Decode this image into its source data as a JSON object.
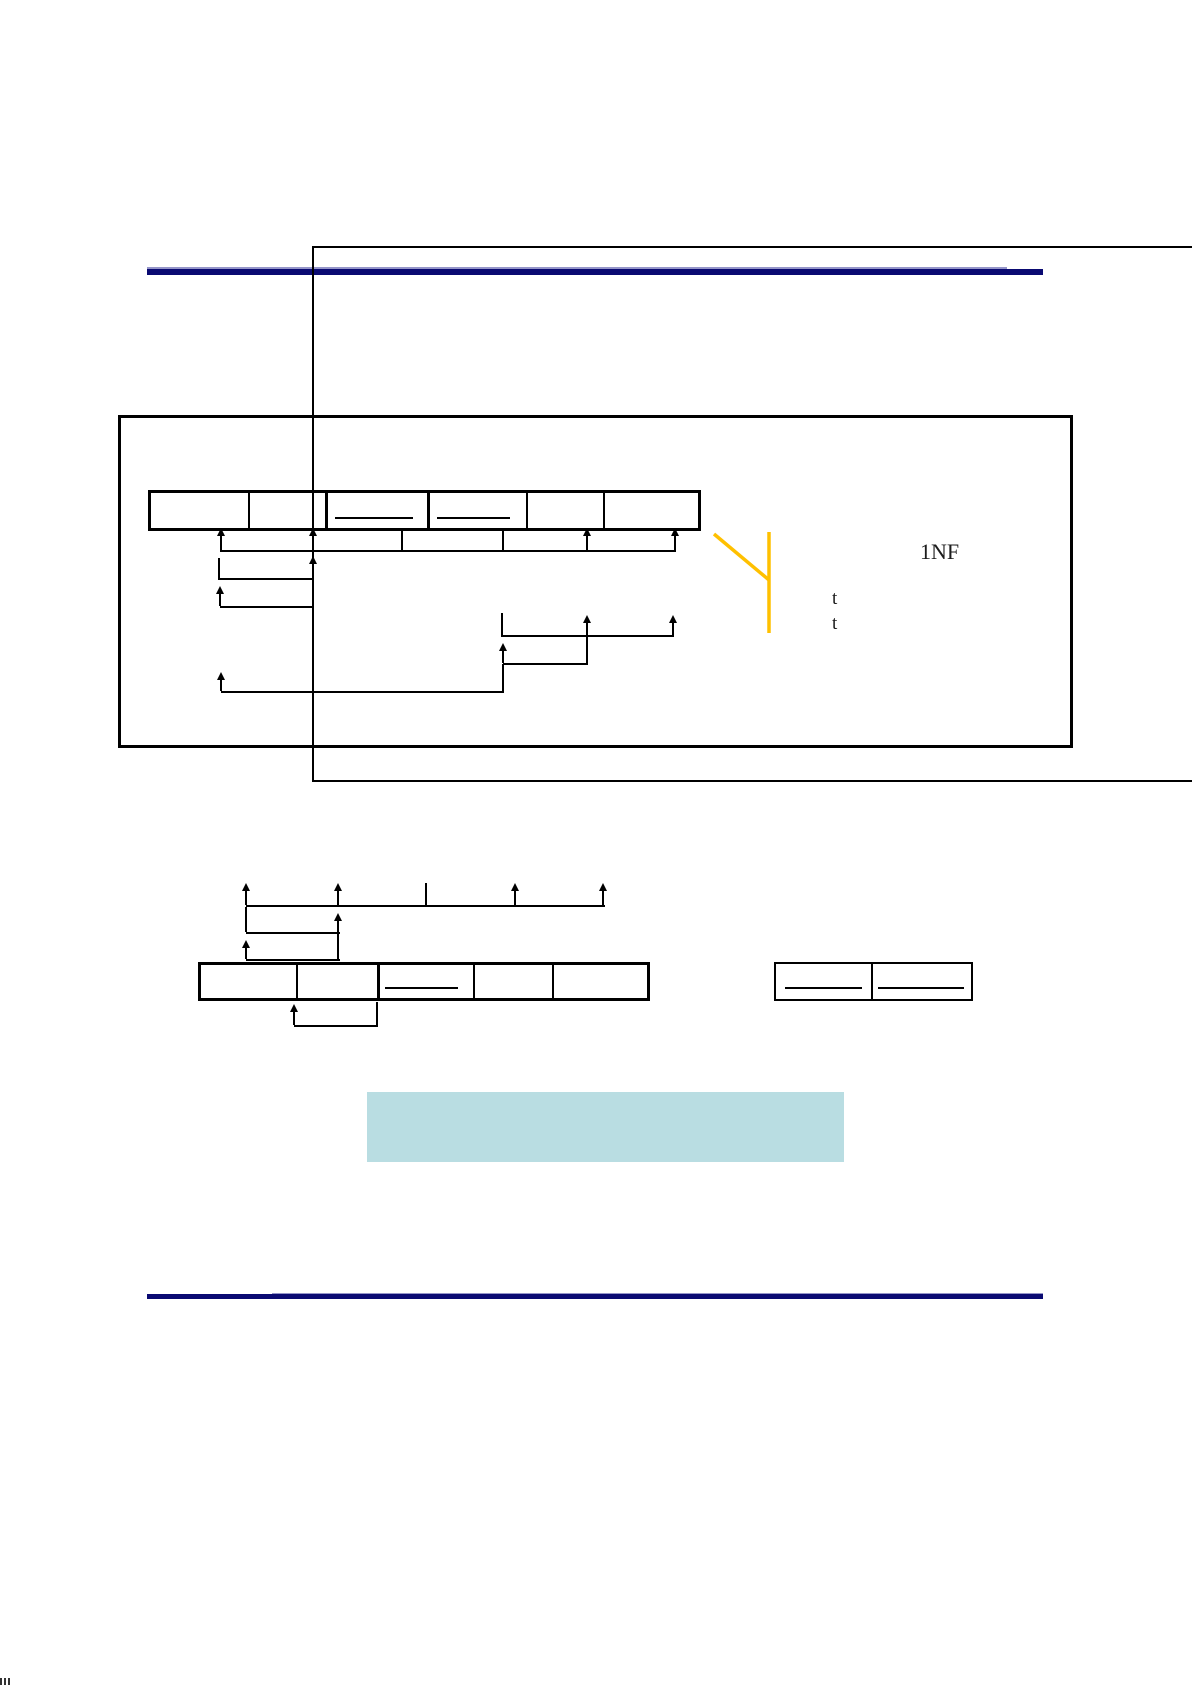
{
  "document": {
    "labels": {
      "normal_form": "1NF",
      "tuple_var_1": "t",
      "tuple_var_2": "t"
    },
    "colors": {
      "divider_navy": "#0a0a72",
      "divider_navy_light": "#9595c9",
      "line_black": "#000000",
      "branch_orange": "#ffc000",
      "highlight_fill": "#b9dde2"
    }
  }
}
